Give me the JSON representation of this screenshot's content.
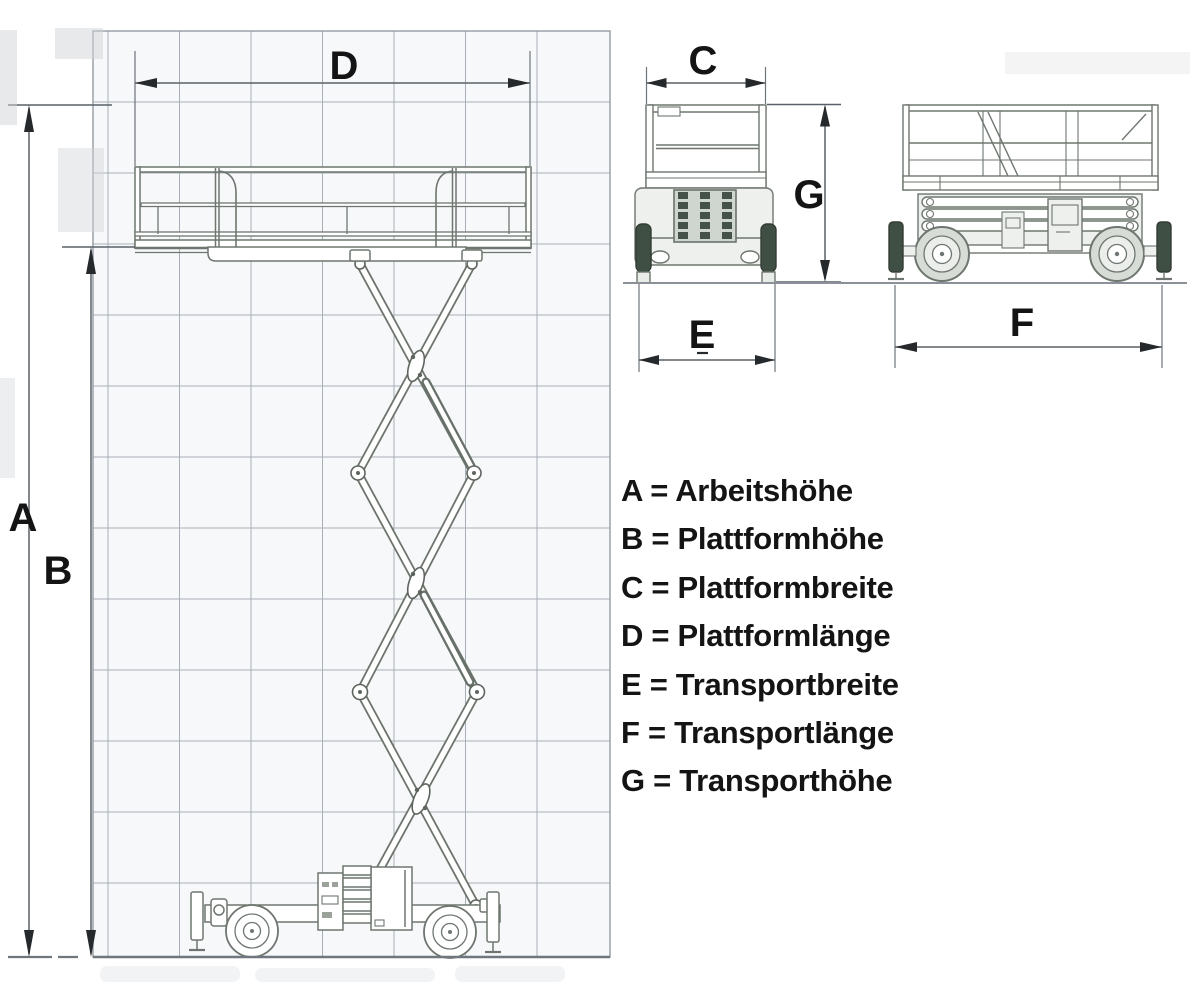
{
  "figure": {
    "kind": "scissor-lift-dimension-diagram"
  },
  "dimension_labels": {
    "A": "A",
    "B": "B",
    "C": "C",
    "D": "D",
    "E": "E",
    "F": "F",
    "G": "G"
  },
  "legend": {
    "items": [
      {
        "text": "A = Arbeitshöhe"
      },
      {
        "text": "B = Plattformhöhe"
      },
      {
        "text": "C = Plattformbreite"
      },
      {
        "text": "D = Plattformlänge"
      },
      {
        "text": "E = Transportbreite"
      },
      {
        "text": "F = Transportlänge"
      },
      {
        "text": "G = Transporthöhe"
      }
    ]
  },
  "colors": {
    "background": "#ffffff",
    "grid_line": "#a6acb5",
    "grid_area": "#f6f7f9",
    "drawing_line": "#6e766f",
    "dark_component": "#3f4f44",
    "dimension_line": "#4e545b",
    "arrowhead": "#26292c",
    "label_text": "#141414"
  }
}
